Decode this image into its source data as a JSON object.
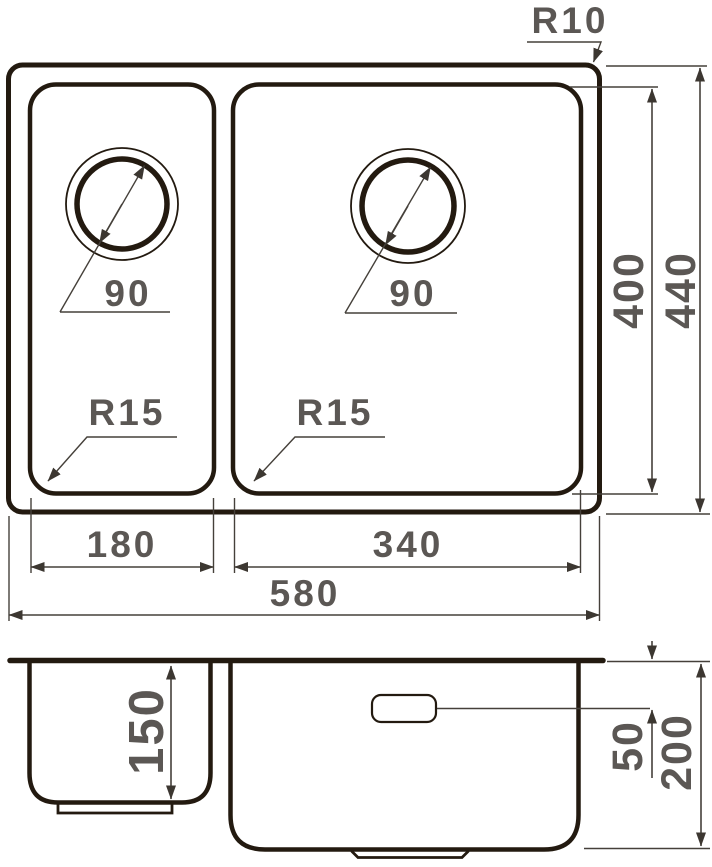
{
  "drawing_title": "double-bowl sink dimensional drawing",
  "colors": {
    "outline": "#231a10",
    "dimension_line": "#45403a",
    "label_text": "#5b5754",
    "background": "#ffffff"
  },
  "top_view": {
    "corner_radius_label": "R10",
    "left_drain_diameter": "90",
    "right_drain_diameter": "90",
    "left_bowl_corner_radius": "R15",
    "right_bowl_corner_radius": "R15",
    "left_bowl_width": "180",
    "right_bowl_width": "340",
    "overall_width": "580",
    "bowl_depth": "400",
    "overall_depth": "440"
  },
  "side_view": {
    "left_bowl_depth": "150",
    "overflow_offset": "50",
    "right_bowl_depth": "200"
  }
}
